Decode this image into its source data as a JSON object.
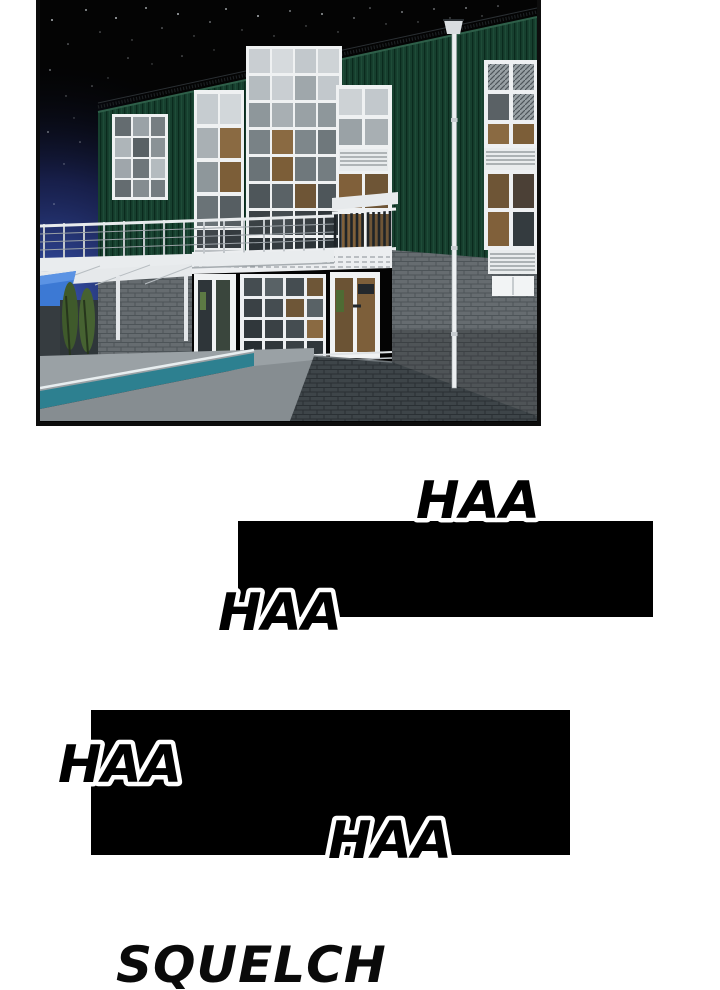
{
  "page": {
    "kind": "webtoon comic page",
    "background_color": "#ffffff"
  },
  "panel": {
    "description": "Night-time 3D architectural render: dark green corrugated two-story building with white mullioned curtain-wall windows, gray brick base, glass entry, roof terrace railing, pergola with blue awning, lap pool on the patio and a tall white lamp post under a starry black sky with a blue glow at the left.",
    "colors": {
      "border": "#0d0d0d",
      "sky": "#040404",
      "night_glow_blue": "#3d5cc0",
      "siding_green": "#17402f",
      "siding_green_dark": "#0a2a1d",
      "window_frame_white": "#eff1f2",
      "brick_gray": "#666c70",
      "brick_gray_dark": "#3e4549",
      "pool_teal": "#2d8090",
      "interior_wood_warm": "#8a6a42",
      "awning_blue": "#3c79d4"
    }
  },
  "censor_bars": {
    "count": 2,
    "color": "#000000"
  },
  "sfx": {
    "haa_top": "HAA",
    "haa_mid": "HAA",
    "haa_left": "HAA",
    "haa_bottom": "HAA",
    "squelch": "SQUELCH"
  }
}
